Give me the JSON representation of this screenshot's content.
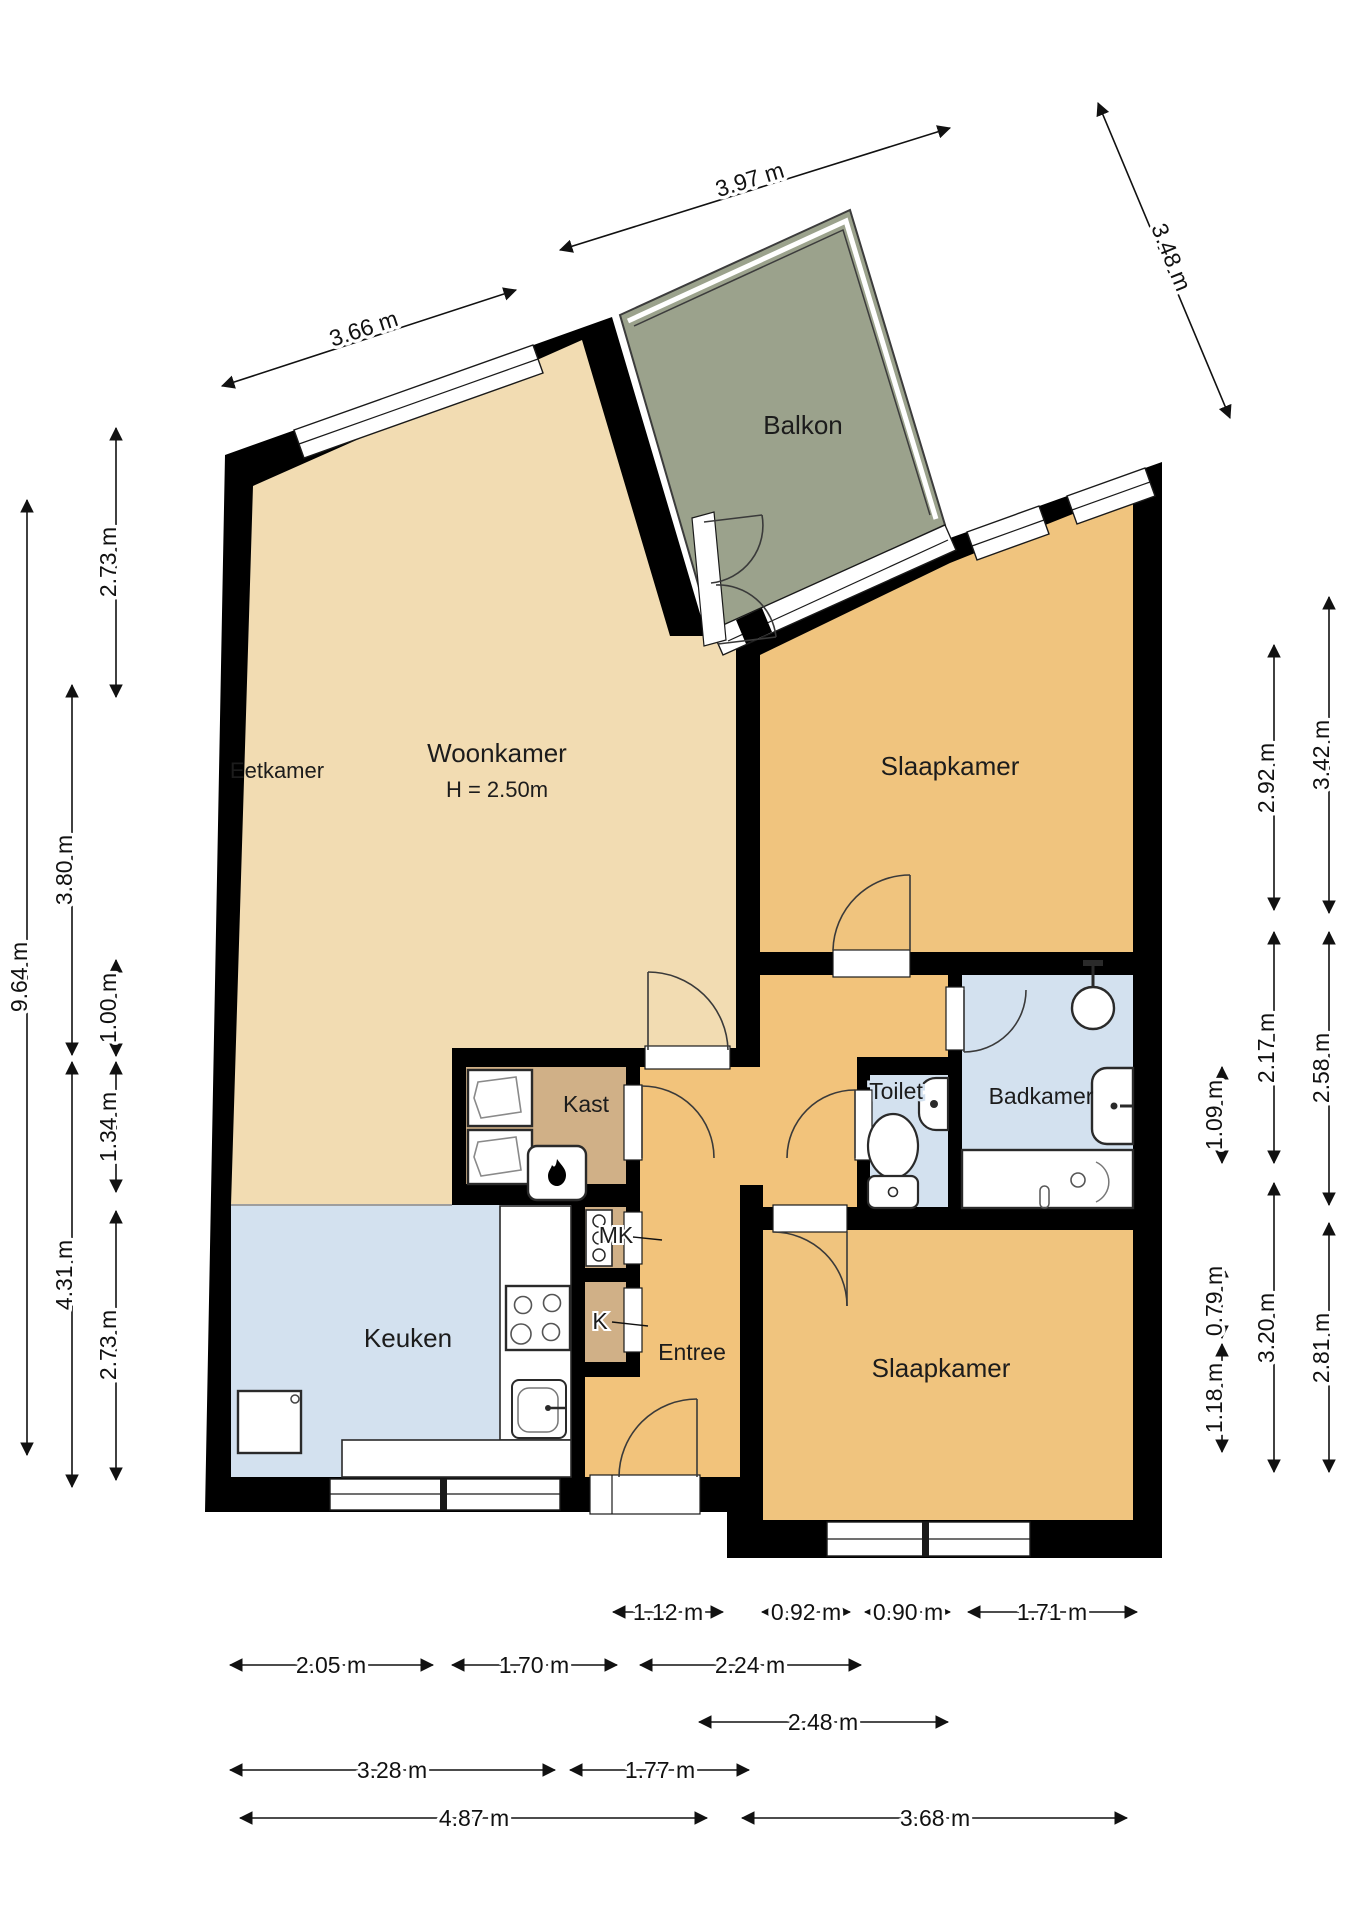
{
  "plan": {
    "type": "floorplan",
    "rooms": [
      {
        "id": "woonkamer",
        "label": "Woonkamer",
        "sub": "H = 2.50m"
      },
      {
        "id": "eetkamer",
        "label": "Eetkamer"
      },
      {
        "id": "balkon",
        "label": "Balkon"
      },
      {
        "id": "slaapkamer-1",
        "label": "Slaapkamer"
      },
      {
        "id": "slaapkamer-2",
        "label": "Slaapkamer"
      },
      {
        "id": "keuken",
        "label": "Keuken"
      },
      {
        "id": "badkamer",
        "label": "Badkamer"
      },
      {
        "id": "toilet",
        "label": "Toilet"
      },
      {
        "id": "entree",
        "label": "Entree"
      },
      {
        "id": "kast",
        "label": "Kast"
      },
      {
        "id": "mk",
        "label": "MK"
      },
      {
        "id": "k",
        "label": "K"
      }
    ],
    "colors": {
      "wall": "#000000",
      "living": "#f2dcb2",
      "bedroom_hall": "#f2c37b",
      "closet": "#d0b087",
      "wet_rooms": "#d3e1ef",
      "balcony": "#9ba28c",
      "background": "#ffffff"
    },
    "dimensions": {
      "top": [
        {
          "label": "3.66 m"
        },
        {
          "label": "3.97 m"
        },
        {
          "label": "3.48 m"
        }
      ],
      "left_outer": [
        {
          "label": "9.64 m"
        }
      ],
      "left_mid": [
        {
          "label": "3.80 m"
        },
        {
          "label": "4.31 m"
        }
      ],
      "left_inner": [
        {
          "label": "2.73 m"
        },
        {
          "label": "1.00 m"
        },
        {
          "label": "1.34 m"
        },
        {
          "label": "2.73 m"
        }
      ],
      "right_inner": [
        {
          "label": "1.09 m"
        },
        {
          "label": "0.79 m"
        },
        {
          "label": "1.18 m"
        }
      ],
      "right_mid": [
        {
          "label": "2.92 m"
        },
        {
          "label": "2.17 m"
        },
        {
          "label": "3.20 m"
        }
      ],
      "right_outer": [
        {
          "label": "3.42 m"
        },
        {
          "label": "2.58 m"
        },
        {
          "label": "2.81 m"
        }
      ],
      "bottom_row1": [
        {
          "label": "1.12 m"
        },
        {
          "label": "0.92 m"
        },
        {
          "label": "0.90 m"
        },
        {
          "label": "1.71 m"
        }
      ],
      "bottom_row2": [
        {
          "label": "2.05 m"
        },
        {
          "label": "1.70 m"
        },
        {
          "label": "2.24 m"
        }
      ],
      "bottom_row3": [
        {
          "label": "2.48 m"
        }
      ],
      "bottom_row4": [
        {
          "label": "3.28 m"
        },
        {
          "label": "1.77 m"
        }
      ],
      "bottom_row5": [
        {
          "label": "4.87 m"
        },
        {
          "label": "3.68 m"
        }
      ]
    }
  }
}
